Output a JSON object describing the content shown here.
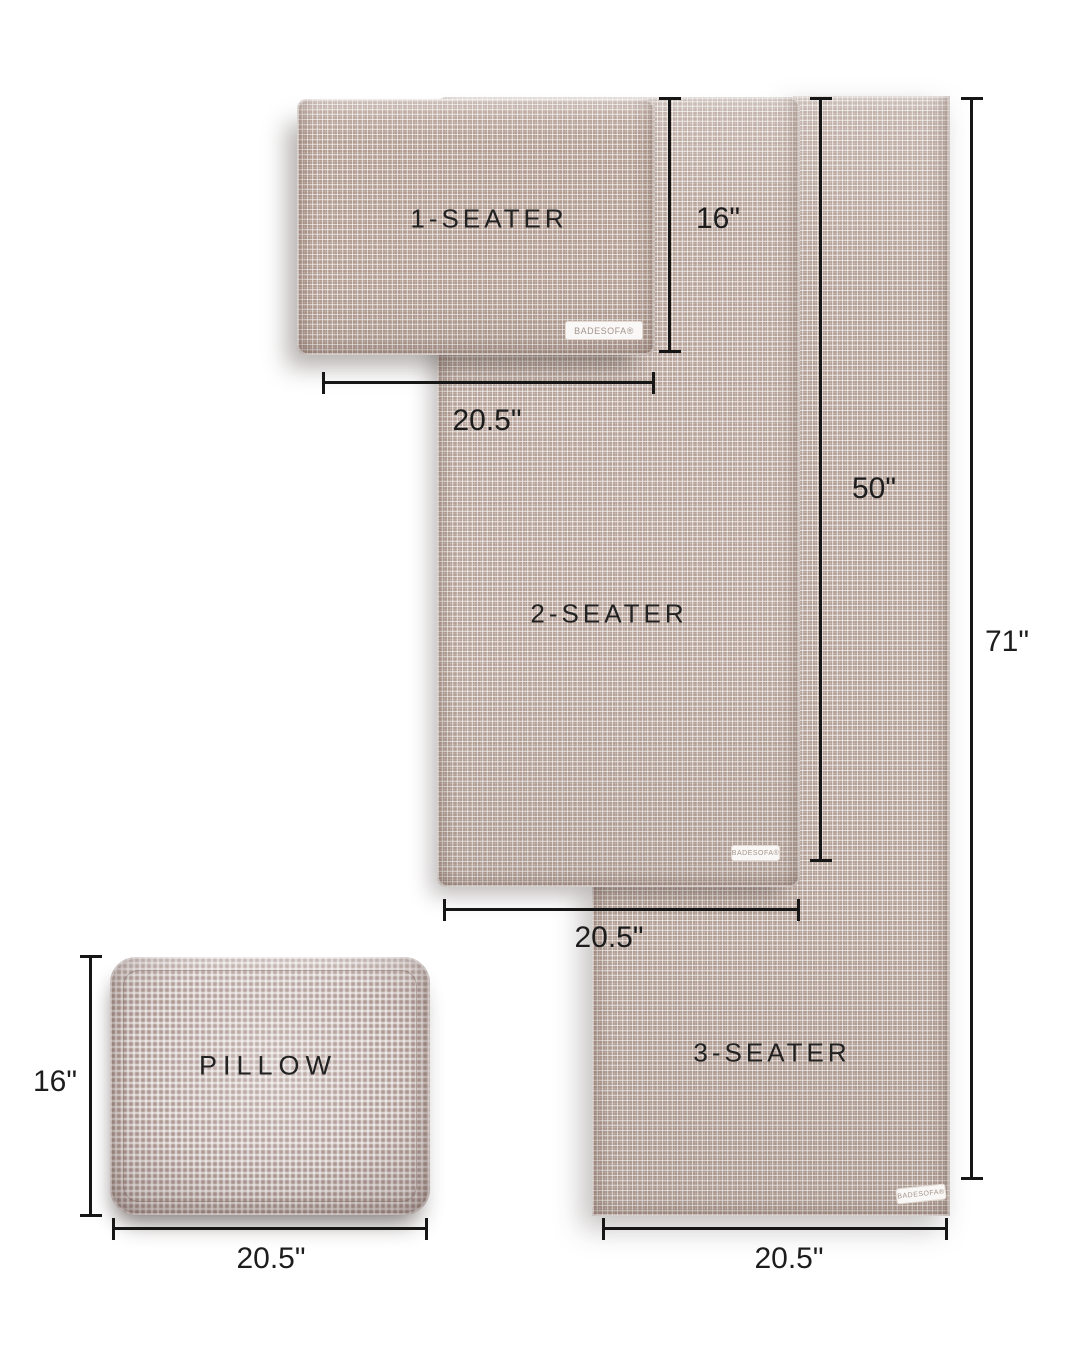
{
  "figure": {
    "type": "sofa-cover-size-guide",
    "background": "#ffffff",
    "line_color": "#161616",
    "text_color": "#222222"
  },
  "brand": {
    "tag": "BADESOFA®"
  },
  "colors": {
    "fabric_one_seater": "#c9b8af",
    "fabric_two_seater": "#cfc1b9",
    "fabric_three_seater": "#cbbdb5",
    "fabric_pillow": "#c4b5b1"
  },
  "panels": {
    "one_seater": {
      "label": "1-SEATER",
      "height_dim": "16\"",
      "width_dim": "20.5\""
    },
    "two_seater": {
      "label": "2-SEATER",
      "height_dim": "50\"",
      "width_dim": "20.5\""
    },
    "three_seater": {
      "label": "3-SEATER",
      "height_dim": "71\"",
      "width_dim": "20.5\""
    },
    "pillow": {
      "label": "PILLOW",
      "height_dim": "16\"",
      "width_dim": "20.5\""
    }
  }
}
